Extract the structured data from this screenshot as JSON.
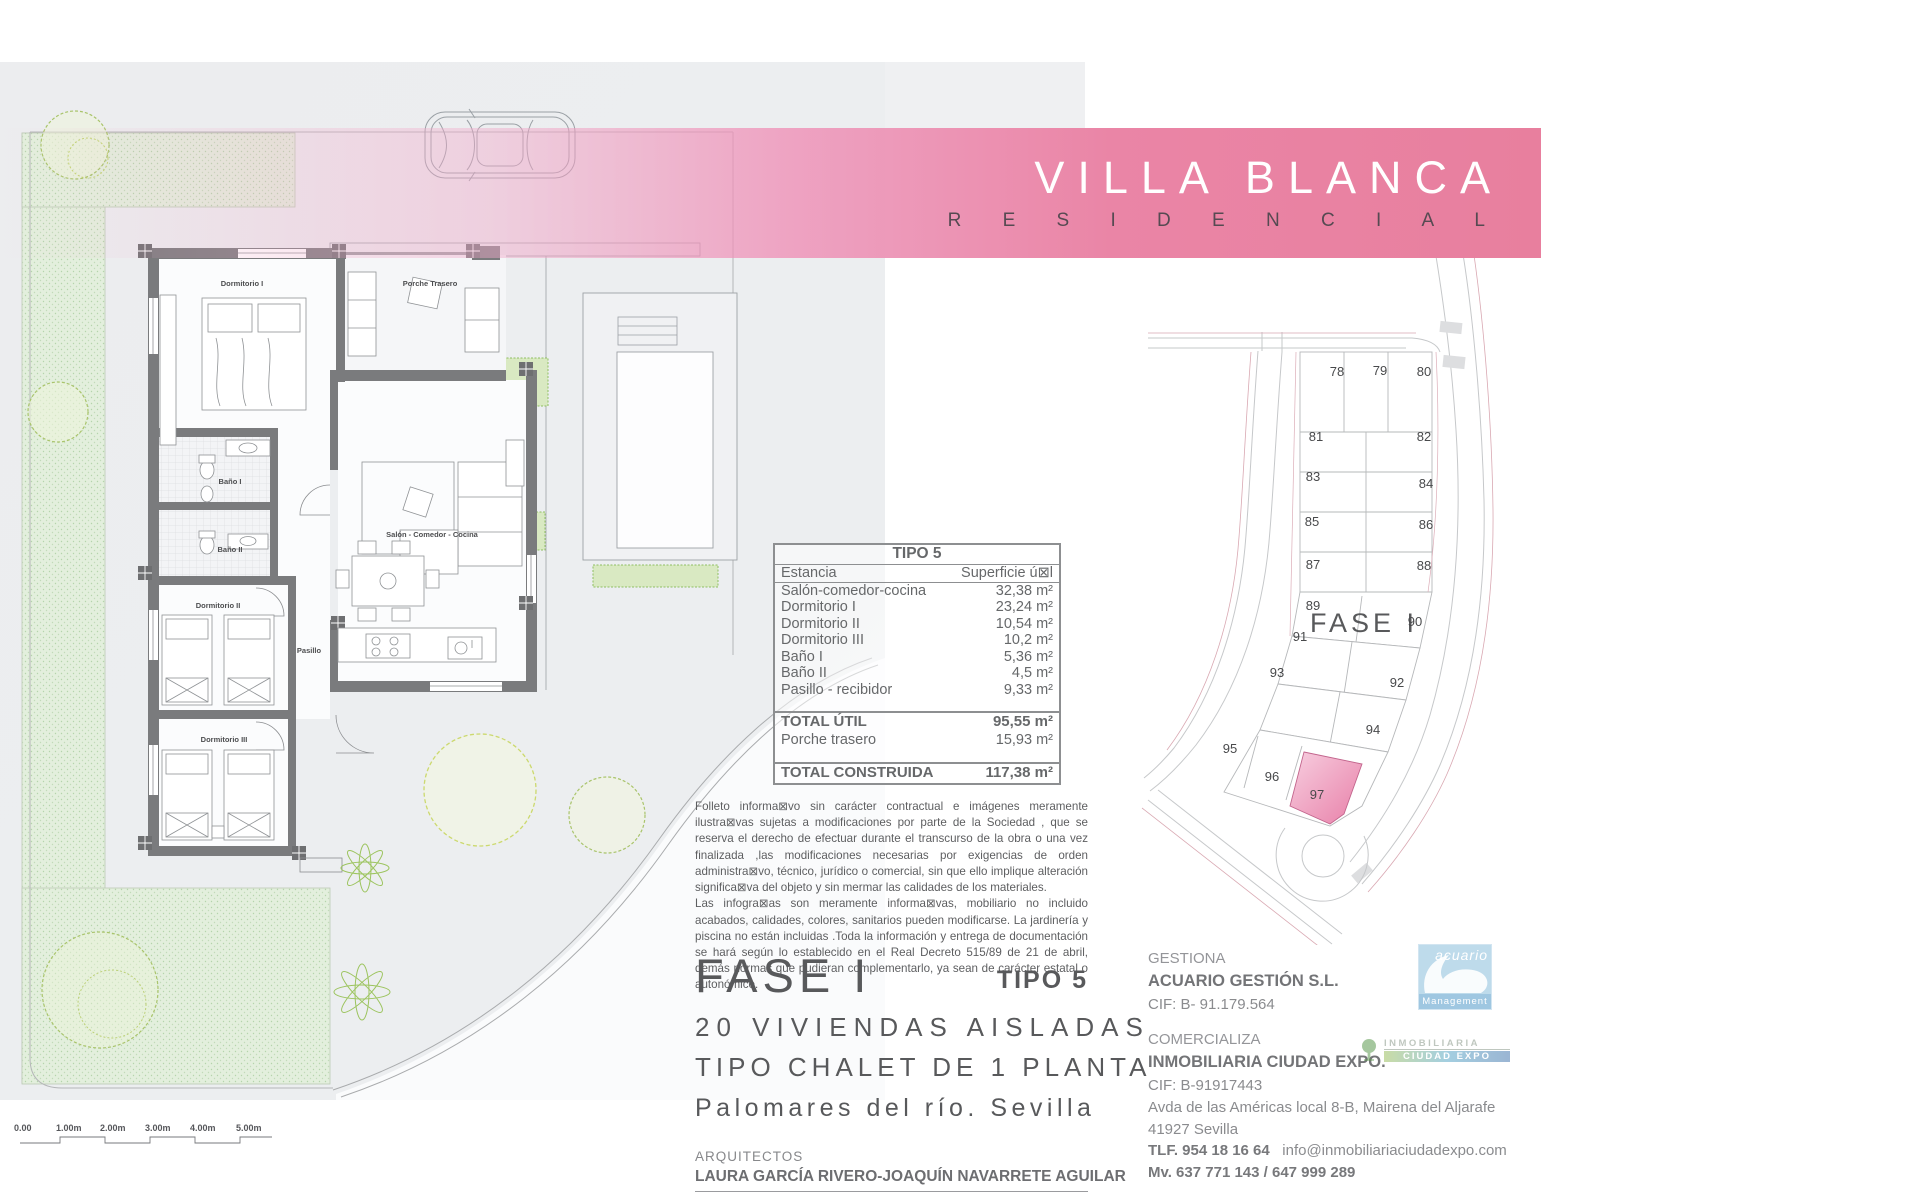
{
  "banner": {
    "title": "VILLA BLANCA",
    "subtitle": "R E S I D E N C I A L"
  },
  "floorplan": {
    "rooms": {
      "dormitorio1": "Dormitorio I",
      "porche": "Porche Trasero",
      "banio1": "Baño I",
      "banio2": "Baño II",
      "dormitorio2": "Dormitorio II",
      "pasillo": "Pasillo",
      "salon": "Salón - Comedor - Cocina",
      "dormitorio3": "Dormitorio III"
    },
    "scale": [
      "0.00",
      "1.00m",
      "2.00m",
      "3.00m",
      "4.00m",
      "5.00m"
    ]
  },
  "table": {
    "title": "TIPO 5",
    "col_room": "Estancia",
    "col_area": "Superficie ú⊠l",
    "rows": [
      {
        "label": "Salón-comedor-cocina",
        "area": "32,38 m²"
      },
      {
        "label": "Dormitorio I",
        "area": "23,24 m²"
      },
      {
        "label": "Dormitorio II",
        "area": "10,54 m²"
      },
      {
        "label": "Dormitorio III",
        "area": "10,2 m²"
      },
      {
        "label": "Baño I",
        "area": "5,36 m²"
      },
      {
        "label": "Baño II",
        "area": "4,5 m²"
      },
      {
        "label": "Pasillo - recibidor",
        "area": "9,33 m²"
      }
    ],
    "total_util_label": "TOTAL ÚTIL",
    "total_util": "95,55 m²",
    "porche_label": "Porche trasero",
    "porche_area": "15,93 m²",
    "total_const_label": "TOTAL CONSTRUIDA",
    "total_const": "117,38 m²"
  },
  "disclaimer": {
    "p1": "Folleto informa⊠vo sin carácter contractual e imágenes meramente ilustra⊠vas sujetas a modificaciones por parte de la Sociedad , que se reserva el derecho de efectuar durante el transcurso de la obra o una vez finalizada ,las modificaciones necesarias por exigencias de orden administra⊠vo, técnico, jurídico o comercial, sin que ello implique alteración significa⊠va del objeto y sin mermar las calidades de los materiales.",
    "p2": "Las infogra⊠as son meramente informa⊠vas, mobiliario no incluido acabados, calidades, colores, sanitarios pueden modificarse. La jardinería y piscina no están incluidas .Toda la información y entrega de documentación se hará según lo establecido en el Real Decreto 515/89 de 21 de abril, demás normas que pudieran complementarlo, ya sean de carácter estatal o autonómico."
  },
  "project": {
    "fase": "FASE I",
    "tipo": "TIPO 5",
    "line1": "20 VIVIENDAS AISLADAS",
    "line2": "TIPO CHALET DE 1 PLANTA",
    "line3": "Palomares del río. Sevilla",
    "arquitectos_label": "ARQUITECTOS",
    "arquitectos": "LAURA GARCÍA RIVERO-JOAQUÍN NAVARRETE AGUILAR"
  },
  "siteplan": {
    "fase_label": "FASE I",
    "plots": [
      "78",
      "79",
      "80",
      "81",
      "82",
      "83",
      "84",
      "85",
      "86",
      "87",
      "88",
      "89",
      "90",
      "91",
      "92",
      "93",
      "94",
      "95",
      "96",
      "97"
    ]
  },
  "contacts": {
    "gestiona_label": "GESTIONA",
    "gestiona_name": "ACUARIO GESTIÓN S.L.",
    "gestiona_cif": "CIF: B- 91.179.564",
    "comercializa_label": "COMERCIALIZA",
    "comercializa_name": "INMOBILIARIA CIUDAD EXPO.",
    "comercializa_cif": "CIF: B-91917443",
    "address1": "Avda de las Américas local 8-B, Mairena del Aljarafe",
    "address2": "41927 Sevilla",
    "phone": "TLF. 954 18 16 64",
    "email": "info@inmobiliariaciudadexpo.com",
    "mobile": "Mv. 637 771 143  / 647 999 289",
    "acuario_logo_text": "acuario",
    "acuario_logo_sub": "Management",
    "inmo_logo_line1": "INMOBILIARIA",
    "inmo_logo_line2": "CIUDAD EXPO"
  },
  "colors": {
    "banner_pink": "#e87f9e",
    "plot_highlight": "#e87fa8",
    "wall_gray": "#7a7b7d",
    "green_area": "#e3efdd"
  }
}
